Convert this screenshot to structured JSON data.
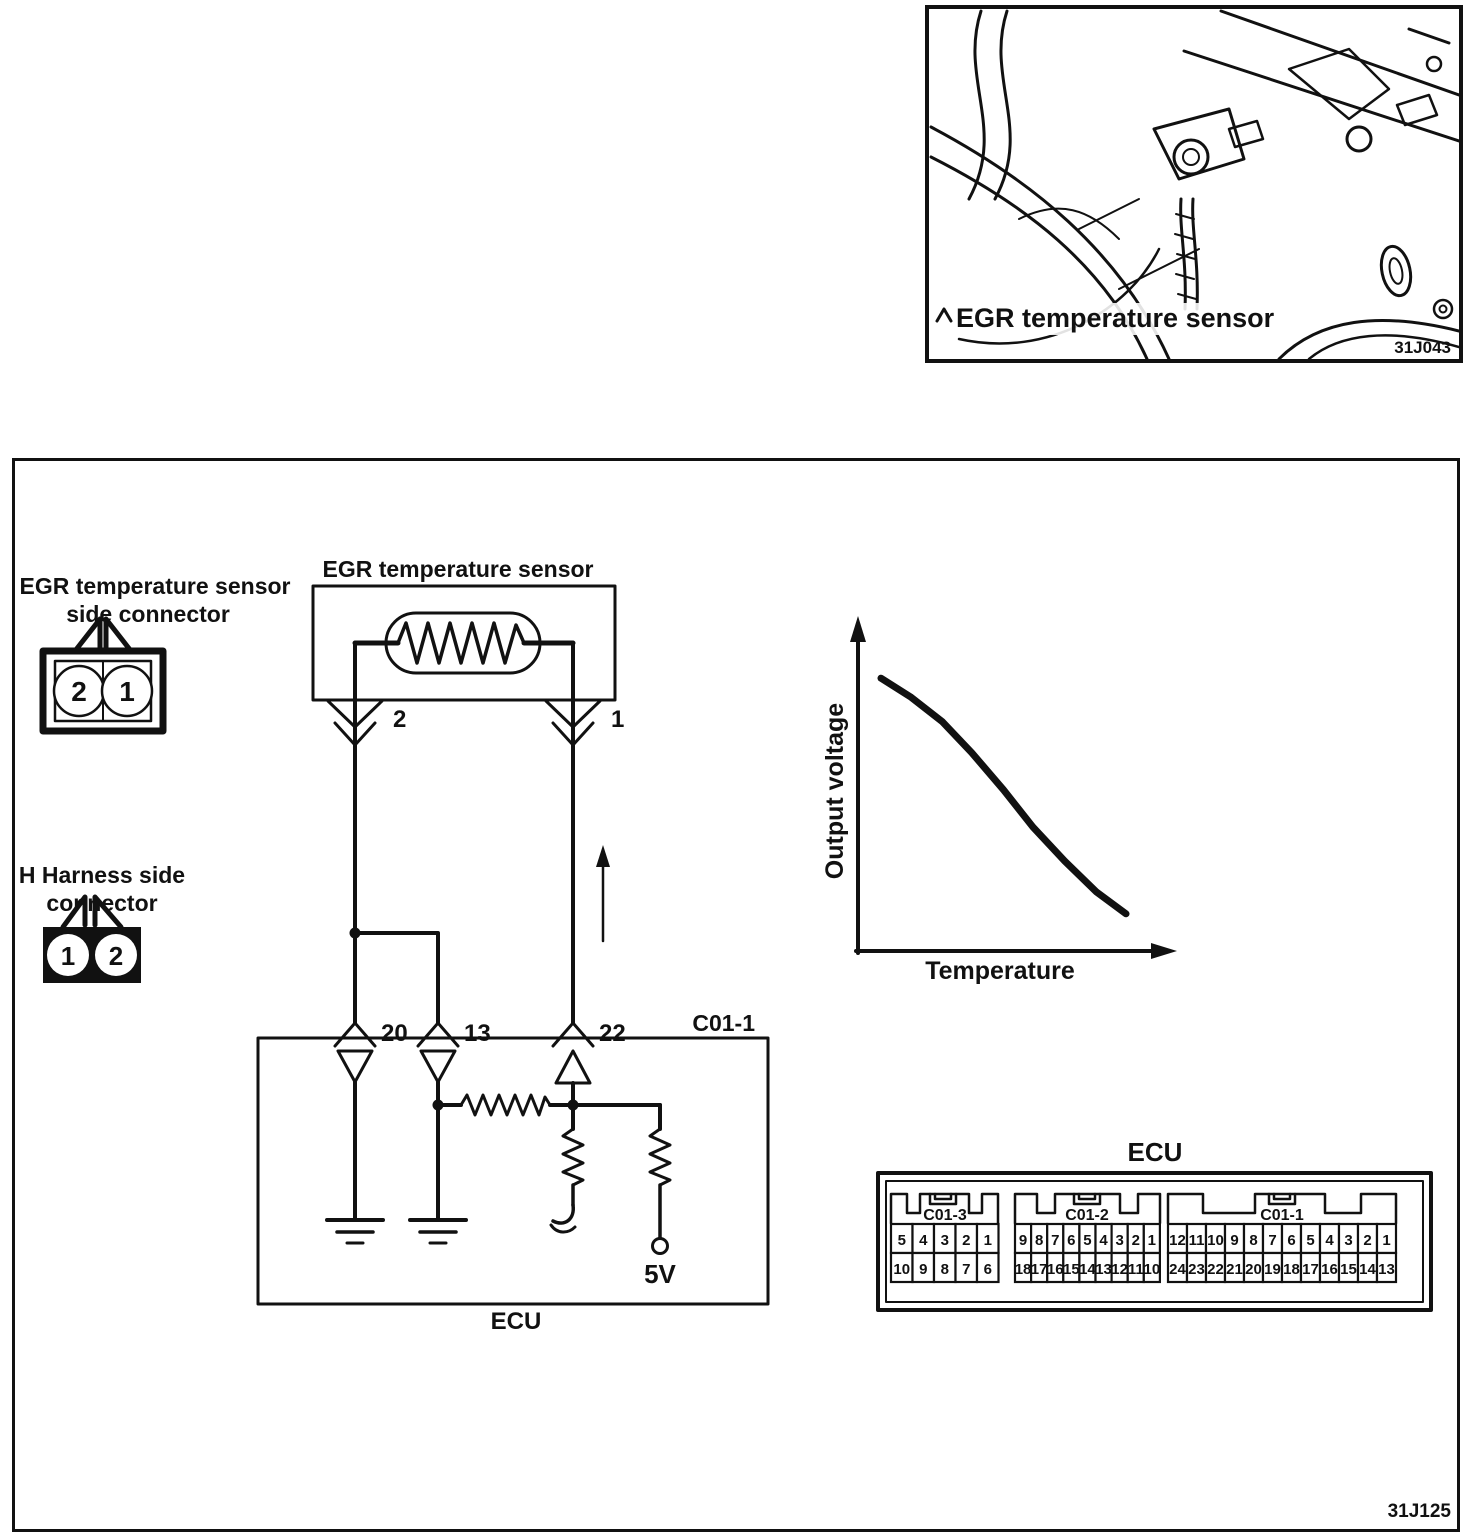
{
  "photo_panel": {
    "caption": "EGR temperature sensor",
    "figure_code": "31J043"
  },
  "wiring_panel": {
    "figure_code": "31J125",
    "sensor_side_connector": {
      "label_line1": "EGR temperature sensor",
      "label_line2": "side connector",
      "pin_left": "2",
      "pin_right": "1"
    },
    "harness_side_connector": {
      "label_line1": "H Harness side",
      "label_line2": "connector",
      "pin_left": "1",
      "pin_right": "2"
    },
    "sensor_title": "EGR temperature sensor",
    "terminal_left": "2",
    "terminal_right": "1",
    "ecu_pin_left": "20",
    "ecu_pin_mid": "13",
    "ecu_pin_right": "22",
    "connector_code": "C01-1",
    "ecu_box_label": "ECU",
    "voltage_label": "5V"
  },
  "chart_data": {
    "type": "line",
    "title": "",
    "xlabel": "Temperature",
    "ylabel": "Output voltage",
    "x": [
      0,
      0.12,
      0.25,
      0.37,
      0.5,
      0.62,
      0.75,
      0.88,
      1
    ],
    "y": [
      0.88,
      0.82,
      0.74,
      0.64,
      0.52,
      0.4,
      0.29,
      0.19,
      0.12
    ],
    "x_range": "unlabeled axis, increasing temperature",
    "y_range": "unlabeled axis, output voltage",
    "grid": false,
    "legend": false
  },
  "ecu_pinout": {
    "title": "ECU",
    "sections": [
      {
        "label": "C01-3",
        "top": [
          "5",
          "4",
          "3",
          "2",
          "1"
        ],
        "bottom": [
          "10",
          "9",
          "8",
          "7",
          "6"
        ]
      },
      {
        "label": "C01-2",
        "top": [
          "9",
          "8",
          "7",
          "6",
          "5",
          "4",
          "3",
          "2",
          "1"
        ],
        "bottom": [
          "18",
          "17",
          "16",
          "15",
          "14",
          "13",
          "12",
          "11",
          "10"
        ]
      },
      {
        "label": "C01-1",
        "top": [
          "12",
          "11",
          "10",
          "9",
          "8",
          "7",
          "6",
          "5",
          "4",
          "3",
          "2",
          "1"
        ],
        "bottom": [
          "24",
          "23",
          "22",
          "21",
          "20",
          "19",
          "18",
          "17",
          "16",
          "15",
          "14",
          "13"
        ]
      }
    ]
  }
}
